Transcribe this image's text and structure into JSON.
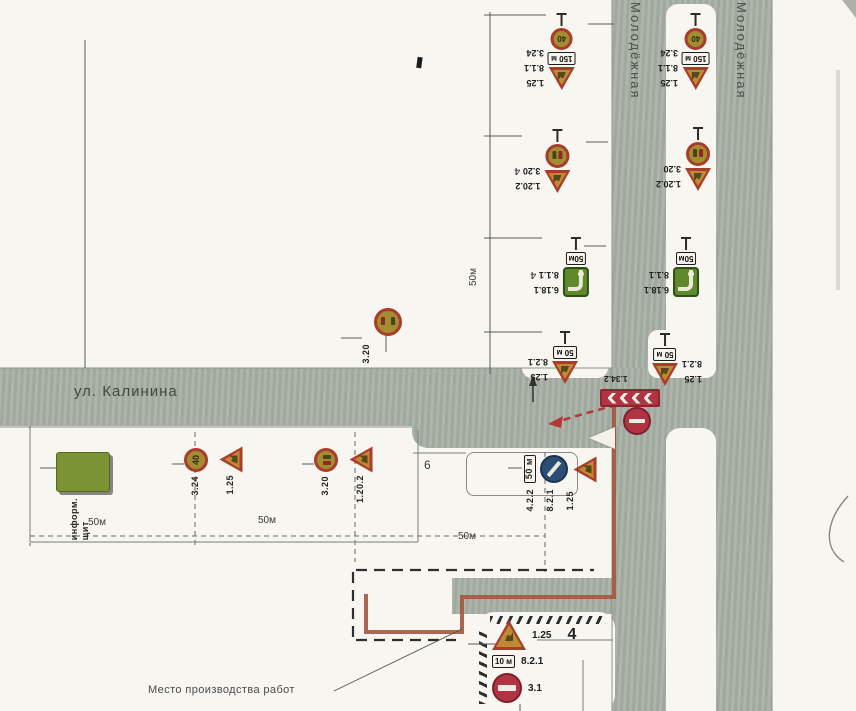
{
  "streets": {
    "kalinina": "ул. Калинина",
    "molodezhnaya": "Молодёжная"
  },
  "labels": {
    "work_site": "Место производства работ",
    "building6": "6",
    "building4": "4",
    "hw4": "4"
  },
  "dims": {
    "v50": "50м",
    "seg1": "50м",
    "seg2": "50м",
    "seg3": "50м"
  },
  "signs": {
    "s125": "1.25",
    "s324": "3.24",
    "s320": "3.20",
    "s1202": "1.20.2",
    "s811": "8.1.1",
    "s821": "8.2.1",
    "s6181": "6.18.1",
    "s422": "4.2.2",
    "s31": "3.1",
    "s1342": "1.34.2",
    "v40": "40",
    "p150": "150 м",
    "p50": "50м",
    "p50b": "50 м",
    "p10": "10 м",
    "board1": "информ.",
    "board2": "щит"
  },
  "colors": {
    "paper": "#f7f6f1",
    "road": "#a9b0a6",
    "signred": "#a93c2a",
    "signfield": "#c08a35",
    "olive": "#a28d33",
    "green": "#5e8a2c",
    "blue": "#2c4e72",
    "redsign": "#b23442",
    "barrier": "#a5573c"
  }
}
